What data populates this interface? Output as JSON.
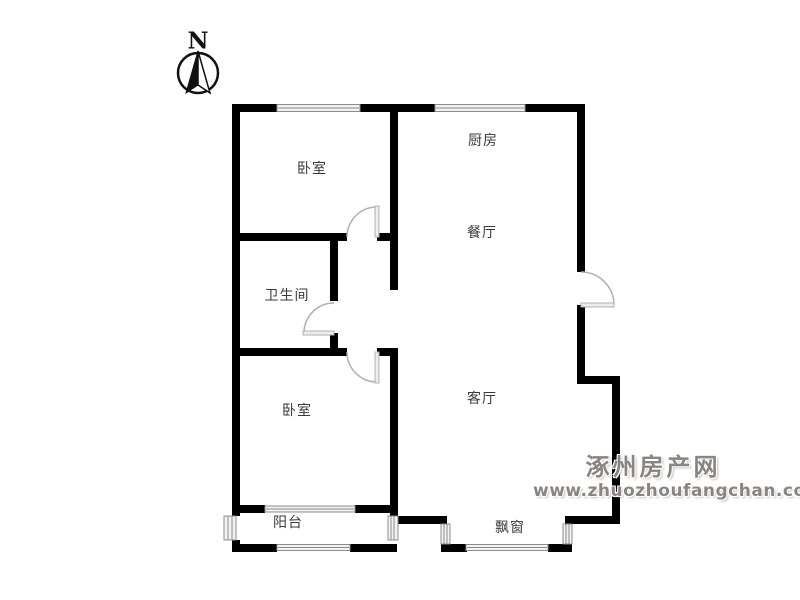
{
  "canvas": {
    "width": 800,
    "height": 600,
    "background": "#ffffff"
  },
  "compass": {
    "label": "N"
  },
  "rooms": [
    {
      "id": "bedroom-top",
      "label": "卧室"
    },
    {
      "id": "kitchen",
      "label": "厨房"
    },
    {
      "id": "dining-room",
      "label": "餐厅"
    },
    {
      "id": "bathroom",
      "label": "卫生间"
    },
    {
      "id": "bedroom-bottom",
      "label": "卧室"
    },
    {
      "id": "living-room",
      "label": "客厅"
    },
    {
      "id": "balcony",
      "label": "阳台"
    },
    {
      "id": "bay-window",
      "label": "飘窗"
    }
  ],
  "watermark": {
    "site_name": "涿州房产网",
    "url": "www.zhuozhoufangchan.com"
  },
  "colors": {
    "background": "#ffffff",
    "wall": "#000000",
    "window_frame": "#8c8c8c",
    "window_fill": "#f2f2f2",
    "door": "#b0b0b0",
    "label_text": "#3a3a3a",
    "watermark_text": "#8a8580"
  }
}
